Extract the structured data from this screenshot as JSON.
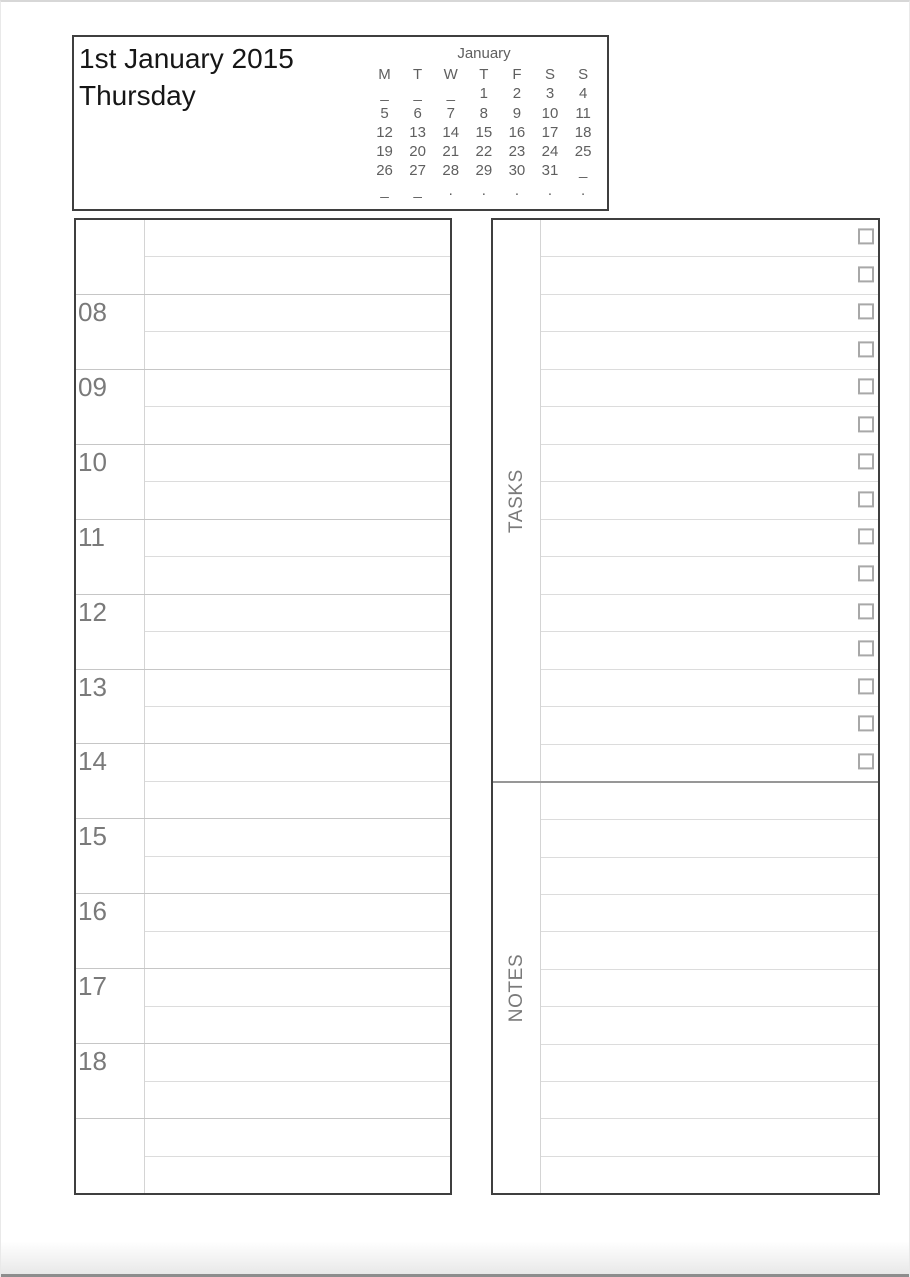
{
  "page": {
    "title_date": "1st January 2015",
    "title_day": "Thursday"
  },
  "calendar": {
    "month": "January",
    "weekdays": [
      "M",
      "T",
      "W",
      "T",
      "F",
      "S",
      "S"
    ],
    "rows": [
      [
        "_",
        "_",
        "_",
        "1",
        "2",
        "3",
        "4"
      ],
      [
        "5",
        "6",
        "7",
        "8",
        "9",
        "10",
        "11"
      ],
      [
        "12",
        "13",
        "14",
        "15",
        "16",
        "17",
        "18"
      ],
      [
        "19",
        "20",
        "21",
        "22",
        "23",
        "24",
        "25"
      ],
      [
        "26",
        "27",
        "28",
        "29",
        "30",
        "31",
        "_"
      ],
      [
        "_",
        "_",
        ".",
        ".",
        ".",
        ".",
        "."
      ]
    ]
  },
  "schedule": {
    "hour_labels": [
      "",
      "08",
      "09",
      "10",
      "11",
      "12",
      "13",
      "14",
      "15",
      "16",
      "17",
      "18",
      ""
    ]
  },
  "tasks": {
    "label": "TASKS",
    "row_count": 15
  },
  "notes": {
    "label": "NOTES",
    "row_count": 11
  },
  "colors": {
    "panel_border": "#3f3f3f",
    "hour_line": "#c6c6c6",
    "half_line": "#dcdcdc",
    "label_divider": "#d4d4d4",
    "section_divider": "#979797",
    "gray_text": "#7a7a7a",
    "calendar_text": "#5f5f5f",
    "checkbox_border": "#a8a8a8",
    "title_text": "#161616"
  }
}
